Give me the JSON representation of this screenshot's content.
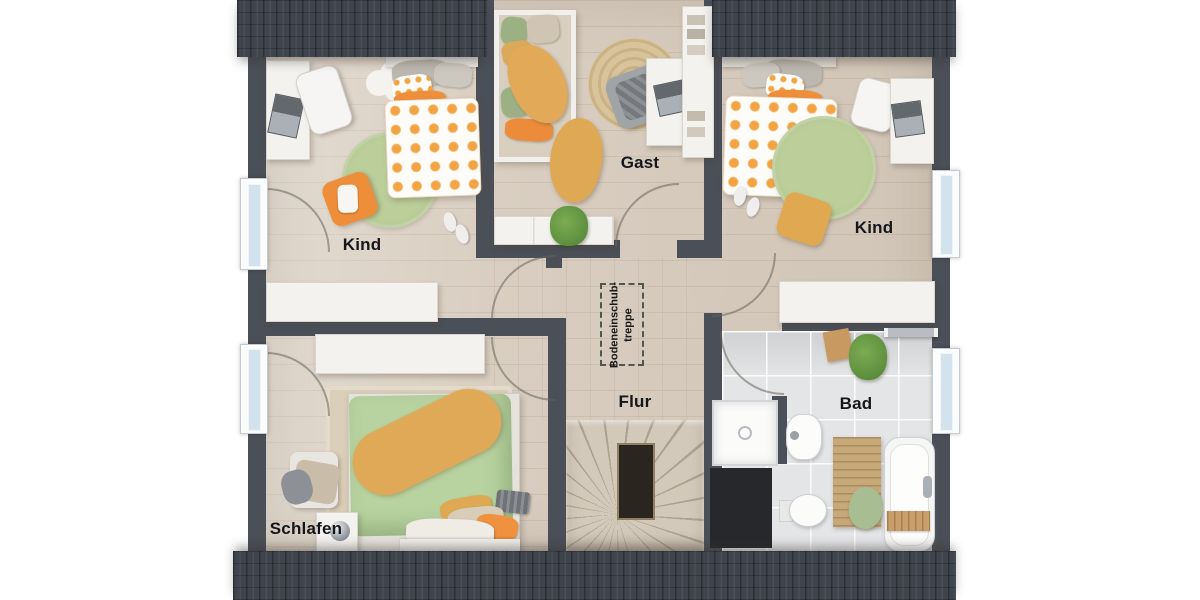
{
  "plan_title": "upper-floor-plan",
  "rooms": [
    {
      "id": "kind-left",
      "label": "Kind"
    },
    {
      "id": "gast",
      "label": "Gast"
    },
    {
      "id": "kind-right",
      "label": "Kind"
    },
    {
      "id": "schlafen",
      "label": "Schlafen"
    },
    {
      "id": "flur",
      "label": "Flur"
    },
    {
      "id": "bad",
      "label": "Bad"
    }
  ],
  "attic_stairs": {
    "line1": "Bodeneinschub-",
    "line2": "treppe"
  },
  "colors": {
    "roof_edge": "#3f444d",
    "wall": "#4b4f57",
    "wood_floor": "#d9cec1",
    "tile_floor": "#e4e5e7",
    "rug_green": "#b7cb96",
    "accent_orange": "#ef913c",
    "duvet_green": "#b8d2a0",
    "throw_mustard": "#e0a957",
    "label_text": "#14161a",
    "background": "#ffffff"
  }
}
